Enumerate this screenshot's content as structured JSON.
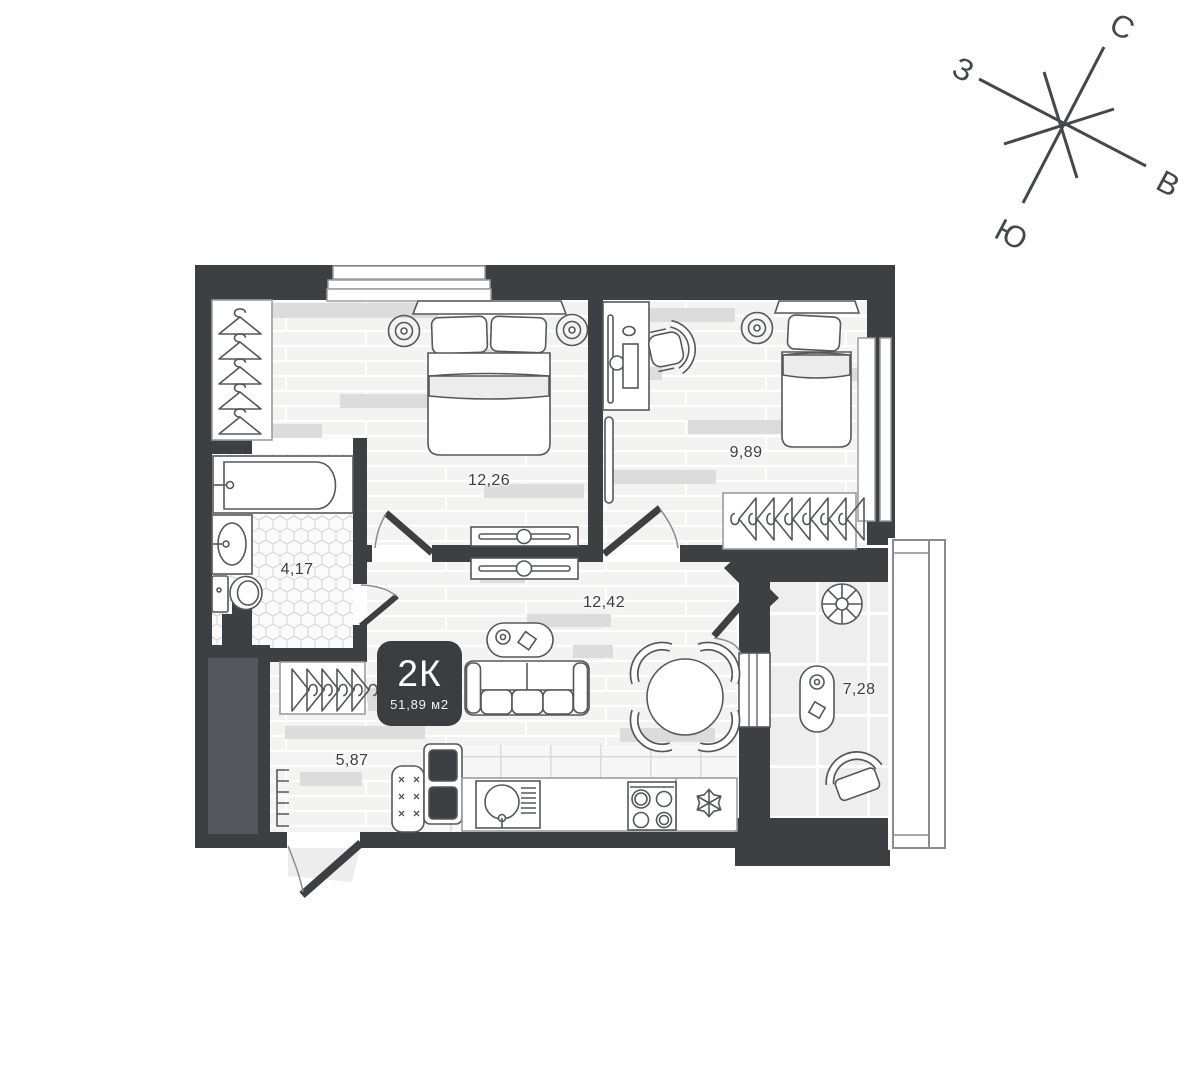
{
  "floor_plan": {
    "badge": {
      "type_label": "2К",
      "area_label": "51,89 м2"
    },
    "rooms": [
      {
        "id": "bedroom-1",
        "area_label": "12,26"
      },
      {
        "id": "bedroom-2",
        "area_label": "9,89"
      },
      {
        "id": "bathroom",
        "area_label": "4,17"
      },
      {
        "id": "living-kitchen",
        "area_label": "12,42"
      },
      {
        "id": "hallway",
        "area_label": "5,87"
      },
      {
        "id": "balcony",
        "area_label": "7,28"
      }
    ],
    "compass": {
      "north": "С",
      "south": "Ю",
      "west": "З",
      "east": "В"
    },
    "colors": {
      "wall": "#3d4043",
      "furniture_stroke": "#55585b",
      "floor_base": "#f3f3f2",
      "accent_plank": "#dcdcdd",
      "badge_bg": "#3b3e41",
      "badge_text": "#ffffff",
      "label_text": "#3b3e41"
    }
  }
}
